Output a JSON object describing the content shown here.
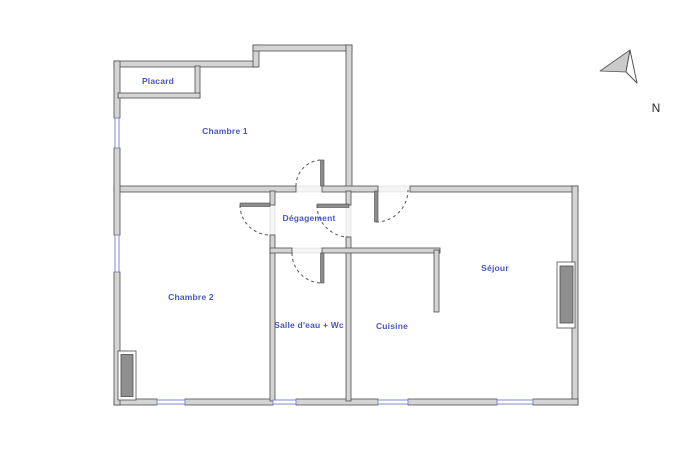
{
  "meta": {
    "type": "apartment-floor-plan",
    "width_px": 700,
    "height_px": 468
  },
  "rooms": {
    "placard": "Placard",
    "chambre1": "Chambre 1",
    "degagement": "Dégagement",
    "chambre2": "Chambre 2",
    "salle_eau": "Salle d'eau + Wc",
    "cuisine": "Cuisine",
    "sejour": "Séjour"
  },
  "compass": {
    "north_label": "N"
  },
  "colors": {
    "wall_fill": "#d4d4d4",
    "wall_stroke": "#4d4d4d",
    "window_color": "#8089cc",
    "leaf_fill": "#8c8c8c",
    "arc_color": "#555555",
    "label_color": "#4a56c0",
    "radiator_fill": "#8f8f8f",
    "compass_stroke": "#555555"
  }
}
